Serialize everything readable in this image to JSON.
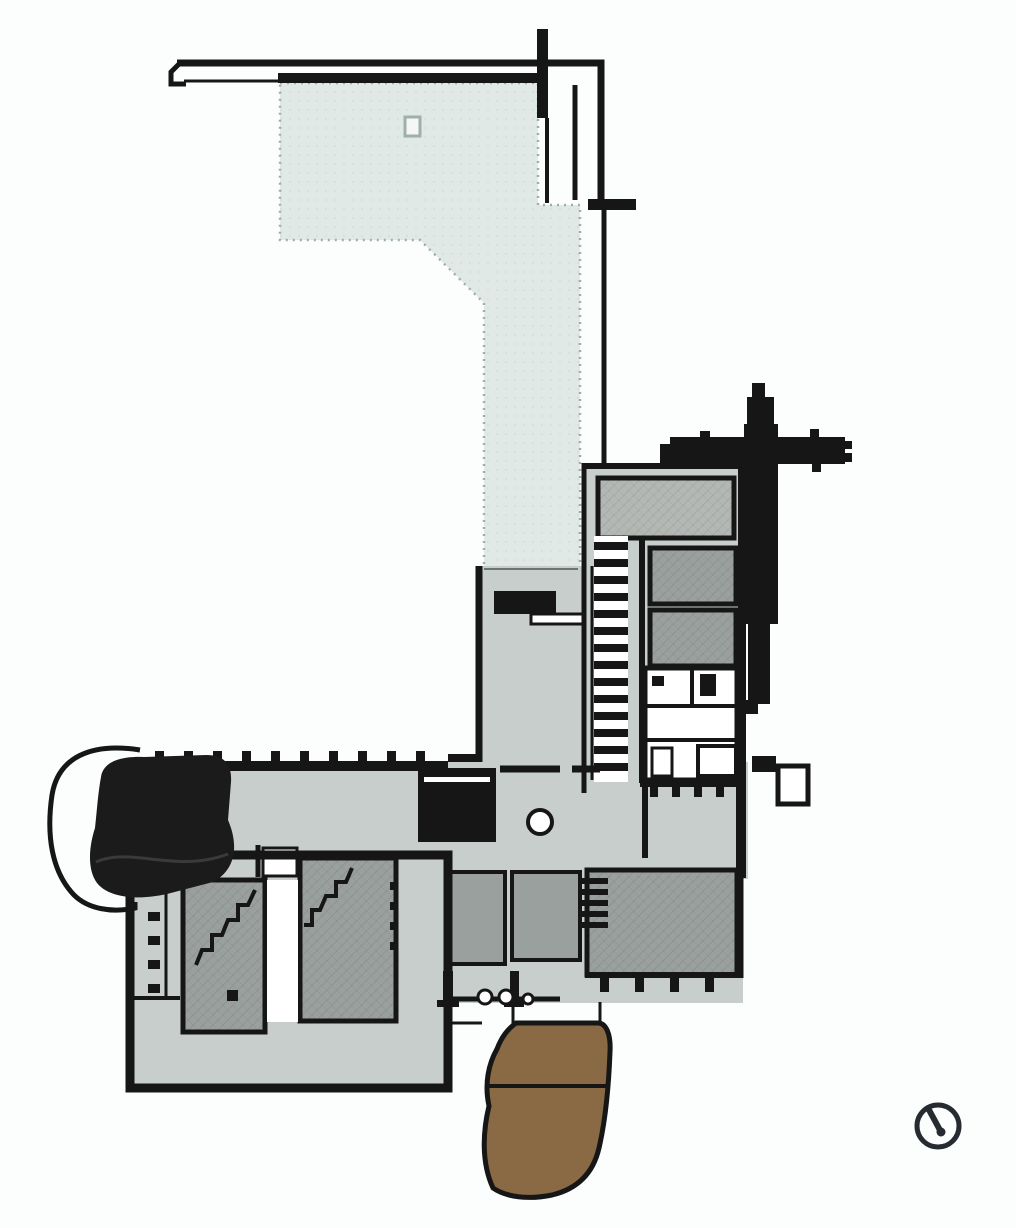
{
  "artifact": {
    "type": "architectural-floor-plan",
    "description": "Monochrome building floor plan with a pale entrance plaza, gray room blocks, a black freeform auditorium, stair runs, a brown terraced ramp and a north-arrow symbol",
    "text_labels": []
  },
  "colors": {
    "background": "#fcfdfd",
    "plaza_fill": "#e1e9e6",
    "plaza_border": "#9fafaa",
    "floor_fill": "#c7cecb",
    "room_fill": "#9aa09d",
    "room_light_fill": "#b3b8b5",
    "wall": "#161616",
    "dark_room_fill": "#1b1b1b",
    "ramp_fill": "#8a6a45",
    "white_fixture": "#ffffff",
    "compass_stroke": "#252b30",
    "boundary_thin": "#6a7672",
    "seam": "#3a3a3a"
  },
  "regions": [
    {
      "name": "site-boundary-lines",
      "role": "property / roof edge lines",
      "color_key": "wall"
    },
    {
      "name": "entrance-plaza",
      "role": "large pale forecourt strip running from top into the lobby",
      "color_key": "plaza_fill"
    },
    {
      "name": "main-lobby",
      "role": "central hall with reception desk, stair block and column",
      "color_key": "floor_fill"
    },
    {
      "name": "east-wing",
      "role": "room block on the right with stair run and service rooms",
      "color_key": "room_fill"
    },
    {
      "name": "south-wing",
      "role": "long horizontal wing with colonnade ticks",
      "color_key": "floor_fill"
    },
    {
      "name": "southwest-block",
      "role": "lower-left block with two stair rooms",
      "color_key": "room_fill"
    },
    {
      "name": "auditorium",
      "role": "black freeform hall with curved outer wall at left end of wing",
      "color_key": "dark_room_fill"
    },
    {
      "name": "tower-cross",
      "role": "solid black cross-shaped element upper right",
      "color_key": "wall"
    },
    {
      "name": "terraced-ramp",
      "role": "brown organic terraced form at bottom center",
      "color_key": "ramp_fill"
    },
    {
      "name": "north-arrow",
      "role": "compass symbol bottom right",
      "color_key": "compass_stroke"
    }
  ],
  "compass": {
    "type": "north-arrow",
    "position": "bottom-right"
  }
}
